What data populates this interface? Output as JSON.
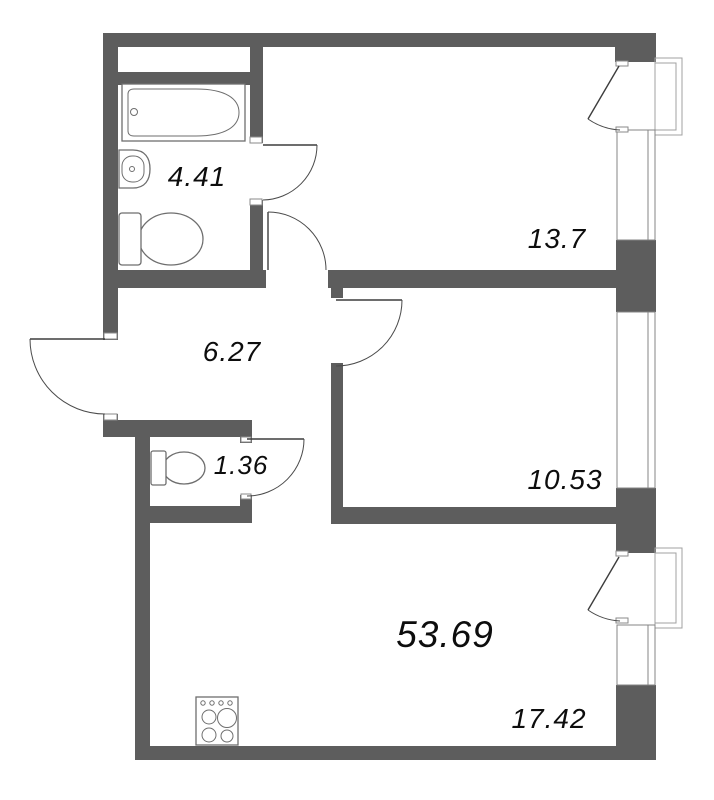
{
  "plan": {
    "type": "apartment-floor-plan",
    "total_area_label": "53.69",
    "rooms": [
      {
        "id": "bathroom",
        "area_label": "4.41"
      },
      {
        "id": "room-top-right",
        "area_label": "13.7"
      },
      {
        "id": "hallway",
        "area_label": "6.27"
      },
      {
        "id": "wc",
        "area_label": "1.36"
      },
      {
        "id": "room-middle",
        "area_label": "10.53"
      },
      {
        "id": "kitchen-living",
        "area_label": "17.42"
      }
    ],
    "fixtures": [
      "bathtub",
      "sink",
      "toilet",
      "toilet",
      "stove"
    ],
    "features": [
      "entrance-door",
      "balcony-top",
      "balcony-bottom",
      "window-top",
      "window-middle",
      "window-bottom"
    ],
    "colors": {
      "wall": "#5d5d5d",
      "door_line": "#3d3d3d",
      "fixture_line": "#6e6e6e",
      "balcony_line": "#a0a0a0",
      "label": "#0d0d0d",
      "background": "#ffffff"
    }
  }
}
